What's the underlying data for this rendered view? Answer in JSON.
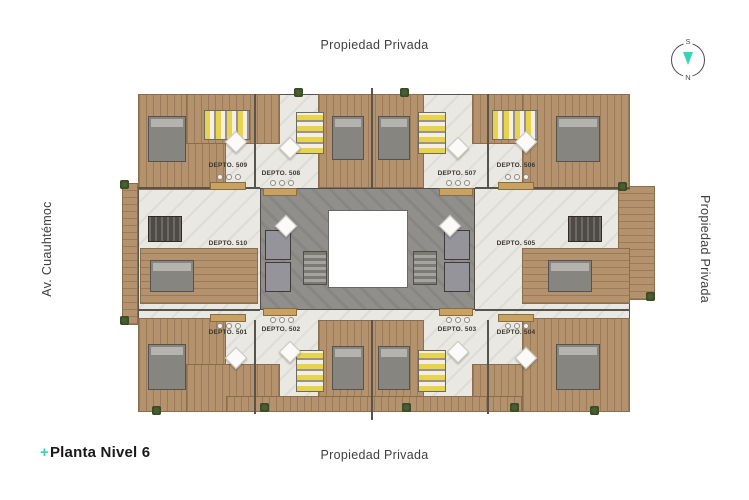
{
  "canvas": {
    "width": 749,
    "height": 500,
    "background": "#ffffff"
  },
  "labels": {
    "top": "Propiedad Privada",
    "bottom": "Propiedad Privada",
    "left": "Av. Cuauhtémoc",
    "right": "Propiedad Privada"
  },
  "title": {
    "plus": "+",
    "text": "Planta Nivel 6"
  },
  "compass": {
    "south": "S",
    "north": "N",
    "needle_color": "#35d4b7"
  },
  "colors": {
    "accent_teal": "#35d4b7",
    "street_label_text": "#3f3f3f",
    "title_text": "#191919",
    "unit_label_text": "#3a372e",
    "wood_deck": "#b5926e",
    "marble_floor": "#eae8e3",
    "wall": "#57544e",
    "concrete_core": "#908f8b",
    "bed_yellow": "#e8d34c",
    "kitchen_wood": "#c8a262",
    "plant_green": "#44582f"
  },
  "plan": {
    "units": [
      {
        "id": "501",
        "label": "DEPTO. 501"
      },
      {
        "id": "502",
        "label": "DEPTO. 502"
      },
      {
        "id": "503",
        "label": "DEPTO. 503"
      },
      {
        "id": "504",
        "label": "DEPTO. 504"
      },
      {
        "id": "505",
        "label": "DEPTO. 505"
      },
      {
        "id": "506",
        "label": "DEPTO. 506"
      },
      {
        "id": "507",
        "label": "DEPTO. 507"
      },
      {
        "id": "508",
        "label": "DEPTO. 508"
      },
      {
        "id": "509",
        "label": "DEPTO. 509"
      },
      {
        "id": "510",
        "label": "DEPTO. 510"
      }
    ]
  }
}
